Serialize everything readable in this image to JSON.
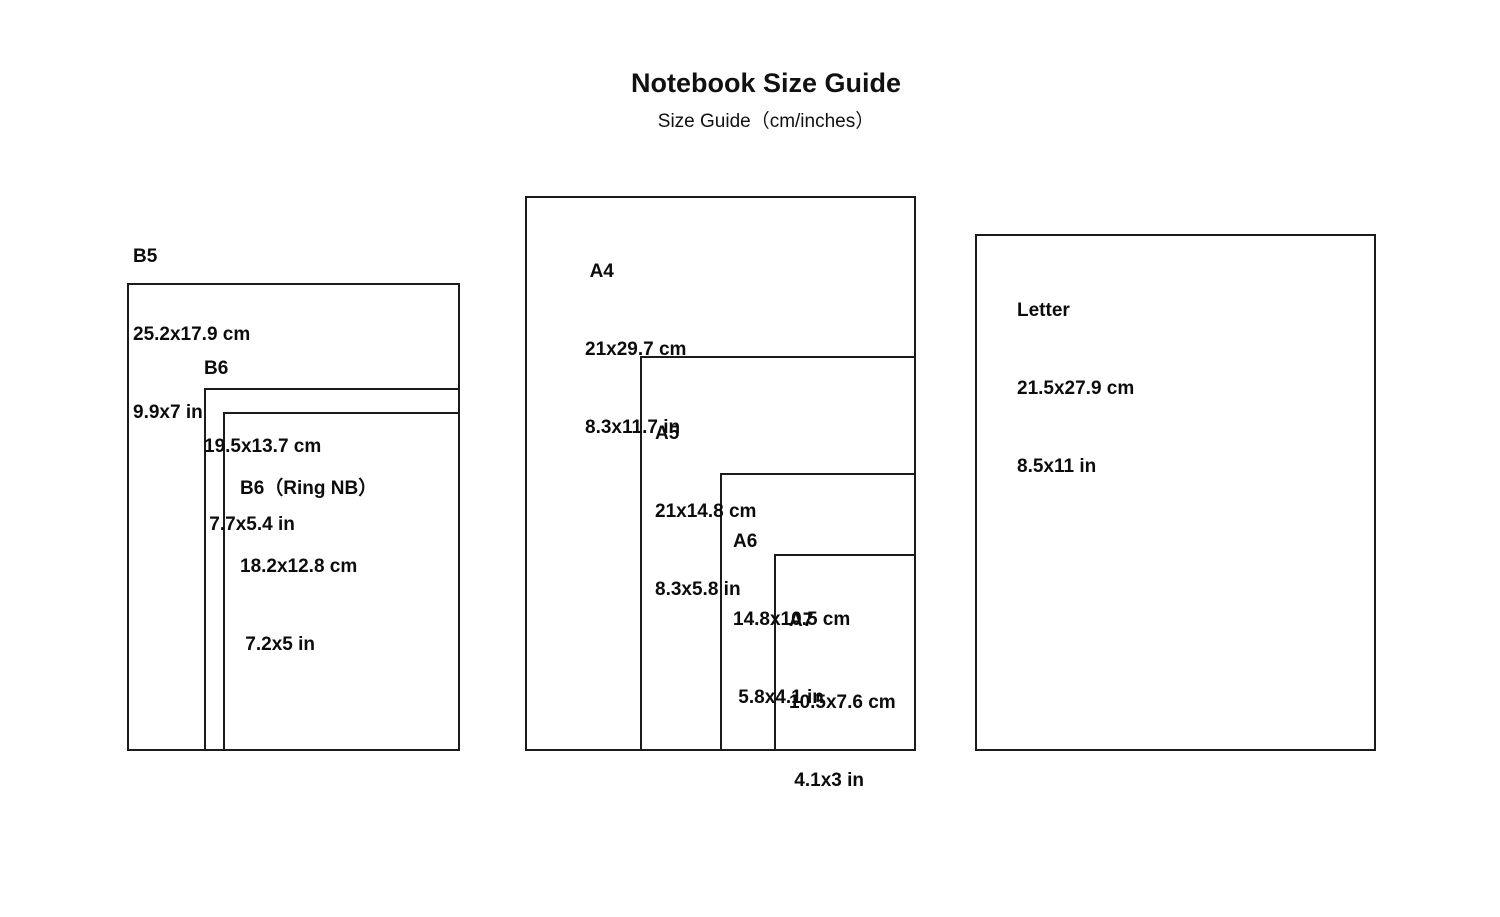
{
  "header": {
    "title": "Notebook Size Guide",
    "subtitle": "Size Guide（cm/inches）"
  },
  "palette": {
    "background": "#ffffff",
    "line": "#1b1b1b",
    "text": "#0c0c0c"
  },
  "sizes": [
    {
      "id": "b5",
      "name": "B5",
      "cm": "25.2x17.9 cm",
      "inches": "9.9x7 in"
    },
    {
      "id": "b6",
      "name": "B6",
      "cm": "19.5x13.7 cm",
      "inches": " 7.7x5.4 in"
    },
    {
      "id": "b6ring",
      "name": "B6（Ring NB）",
      "cm": "18.2x12.8 cm",
      "inches": " 7.2x5 in"
    },
    {
      "id": "a4",
      "name": " A4",
      "cm": "21x29.7 cm",
      "inches": "8.3x11.7 in"
    },
    {
      "id": "a5",
      "name": "A5",
      "cm": "21x14.8 cm",
      "inches": "8.3x5.8 in"
    },
    {
      "id": "a6",
      "name": "A6",
      "cm": "14.8x10.5 cm",
      "inches": " 5.8x4.1 in"
    },
    {
      "id": "a7",
      "name": "A7",
      "cm": "10.5x7.6 cm",
      "inches": " 4.1x3 in"
    },
    {
      "id": "letter",
      "name": "Letter",
      "cm": "21.5x27.9 cm",
      "inches": "8.5x11 in"
    }
  ]
}
